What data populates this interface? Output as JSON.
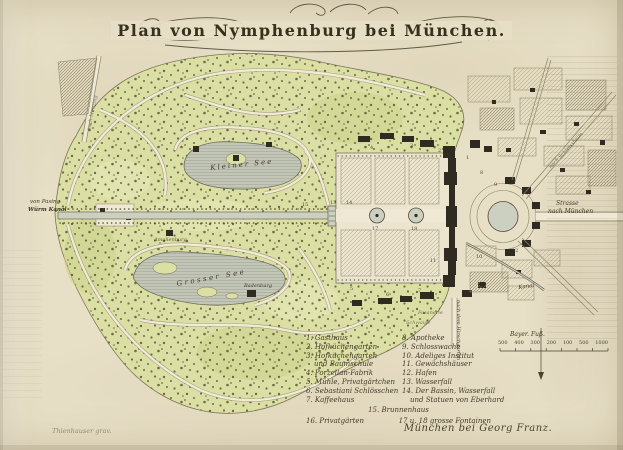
{
  "title": "Plan von Nymphenburg bei München.",
  "labels": {
    "kleiner_see": "Kleiner See",
    "grosser_see": "Grosser See",
    "badenburg": "Badenburg",
    "amalienburg": "Amalienburg",
    "pasing_1": "von Pasing",
    "pasing_2": "Würm Kanal",
    "strasse_1": "Strasse",
    "strasse_2": "nach München",
    "kanal": "Kanal",
    "hirschgarten": "nach dem Hirschgarten",
    "schleissheim": "nach Schleissheim",
    "menzing": "nach Menzing",
    "fasanerie": "Fasanerie",
    "schwaige": "Schwaige"
  },
  "legend": {
    "left": [
      "1. Gasthaus",
      "2. Hofküchengarten",
      "3. Hofküchengarten",
      "und Baumschule",
      "4. Porzellan-Fabrik",
      "5. Mühle, Privatgärtchen",
      "6. Sebastiani Schlösschen",
      "7. Kaffeehaus"
    ],
    "right": [
      "8. Apotheke",
      "9. Schlosswache",
      "10. Adeliges Institut",
      "11. Gewächshäuser",
      "12. Hafen",
      "13. Wasserfall",
      "14. Der Bassin, Wasserfall",
      "und Statuen von Eberhard"
    ],
    "row15": "15. Brunnenhaus",
    "row16": "16. Privatgärten",
    "row17": "17 u. 18 grosse Fontainen"
  },
  "scale": {
    "label": "Bayer. Fuß.",
    "ticks": [
      "500",
      "400",
      "300",
      "200",
      "100",
      "500",
      "1000"
    ]
  },
  "imprint": "München bei Georg Franz.",
  "engraver": "Thienhauser grav.",
  "site_numbers": [
    "1",
    "2",
    "3",
    "4",
    "5",
    "6",
    "7",
    "8",
    "9",
    "10",
    "11",
    "12",
    "13",
    "14",
    "15",
    "17",
    "18"
  ]
}
